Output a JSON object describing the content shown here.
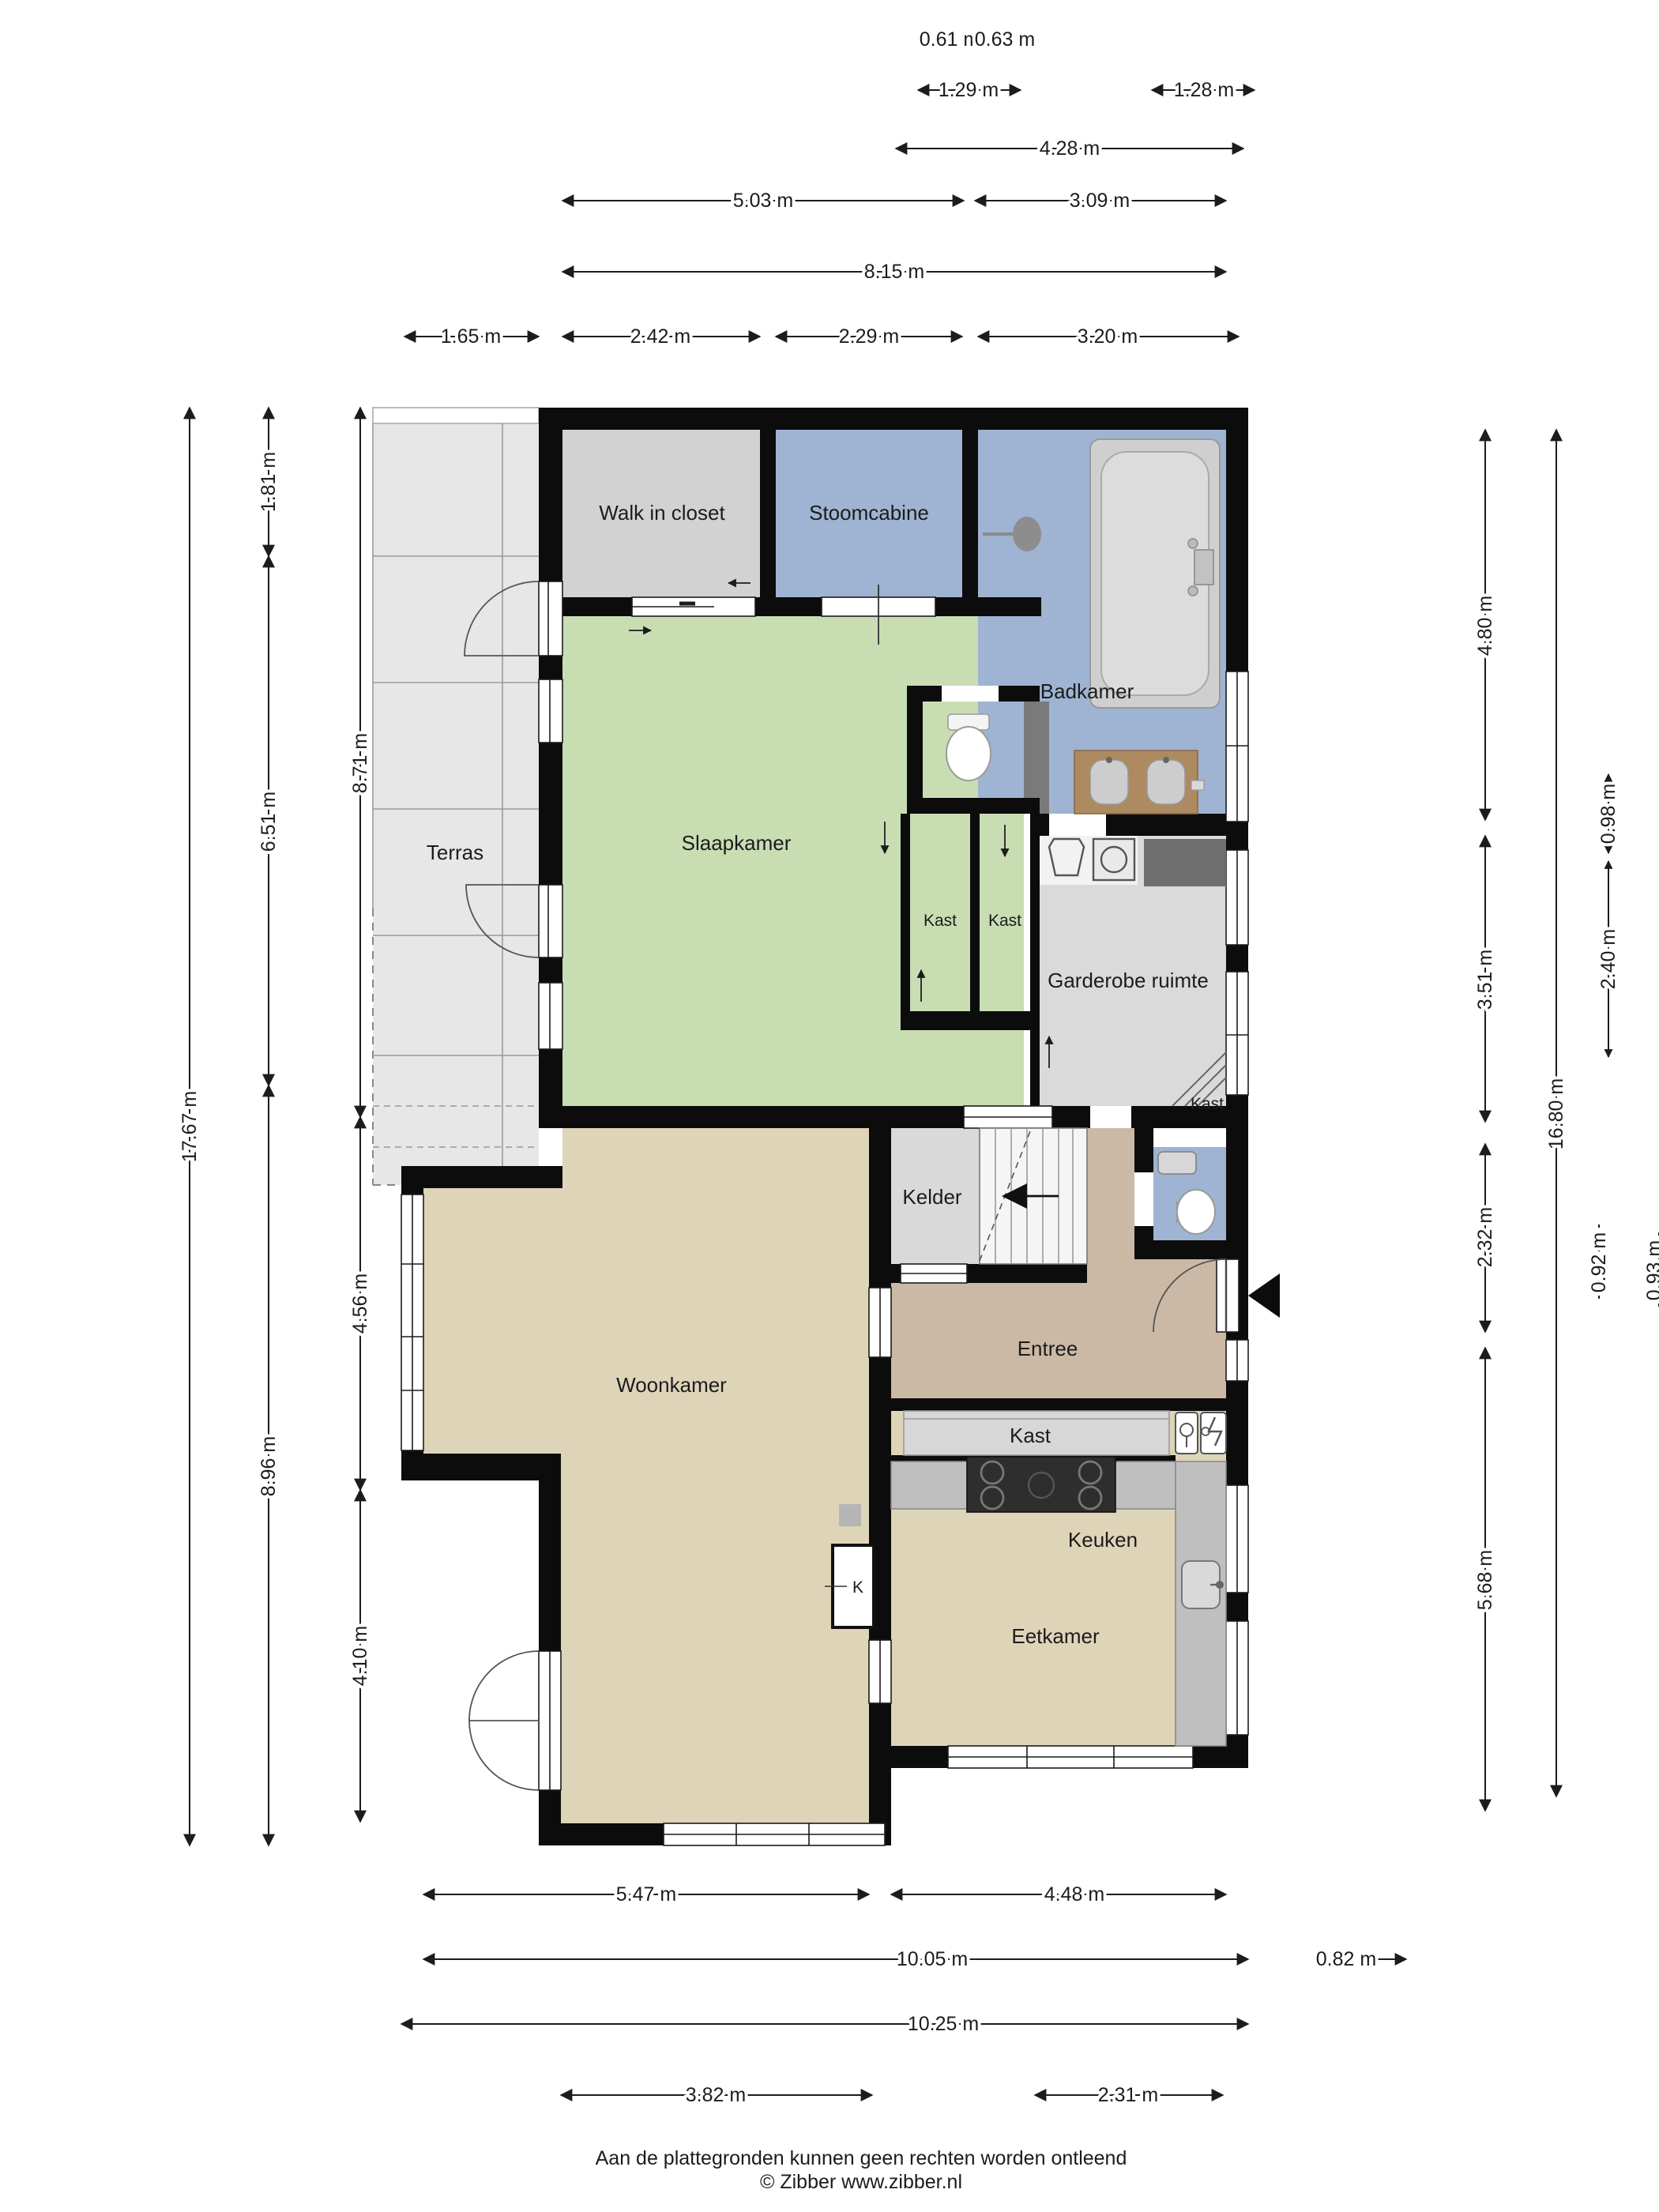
{
  "plan_title": "Begane grond plattegrond",
  "rooms": {
    "walk_in_closet": "Walk in closet",
    "stoomcabine": "Stoomcabine",
    "badkamer": "Badkamer",
    "slaapkamer": "Slaapkamer",
    "terras": "Terras",
    "kast": "Kast",
    "garderobe": "Garderobe ruimte",
    "kelder": "Kelder",
    "entree": "Entree",
    "woonkamer": "Woonkamer",
    "keuken": "Keuken",
    "eetkamer": "Eetkamer",
    "k": "K"
  },
  "dims": {
    "top": [
      "0.61 m",
      "0.63 m",
      "1.29 m",
      "1.28 m",
      "4.28 m",
      "5.03 m",
      "3.09 m",
      "8.15 m",
      "1.65 m",
      "2.42 m",
      "2.29 m",
      "3.20 m"
    ],
    "left": [
      "17.67 m",
      "1.81 m",
      "6.51 m",
      "8.96 m",
      "8.71 m",
      "4.56 m",
      "4.10 m"
    ],
    "right": [
      "4.80 m",
      "3.51 m",
      "2.32 m",
      "5.68 m",
      "16.80 m",
      "0.98 m",
      "2.40 m",
      "0.92 m",
      "0.93 m"
    ],
    "bottom": [
      "5.47 m",
      "4.48 m",
      "10.05 m",
      "0.82 m",
      "10.25 m",
      "3.82 m",
      "2.31 m"
    ]
  },
  "footer": {
    "line1": "Aan de plattegronden kunnen geen rechten worden ontleend",
    "line2": "© Zibber www.zibber.nl"
  },
  "colors": {
    "wall": "#0c0c0c",
    "bedroom_green": "#c9ddb3",
    "bath_blue": "#9fb3d2",
    "living_cream": "#ded4b8",
    "entree_tan": "#cbb9a6",
    "closet_gray": "#d8d8d8",
    "terras_gray": "#e7e7e7",
    "counter_gray": "#bfbfbf",
    "dark_unit": "#6e6e6e",
    "vanity_wood": "#ad8a5f"
  }
}
